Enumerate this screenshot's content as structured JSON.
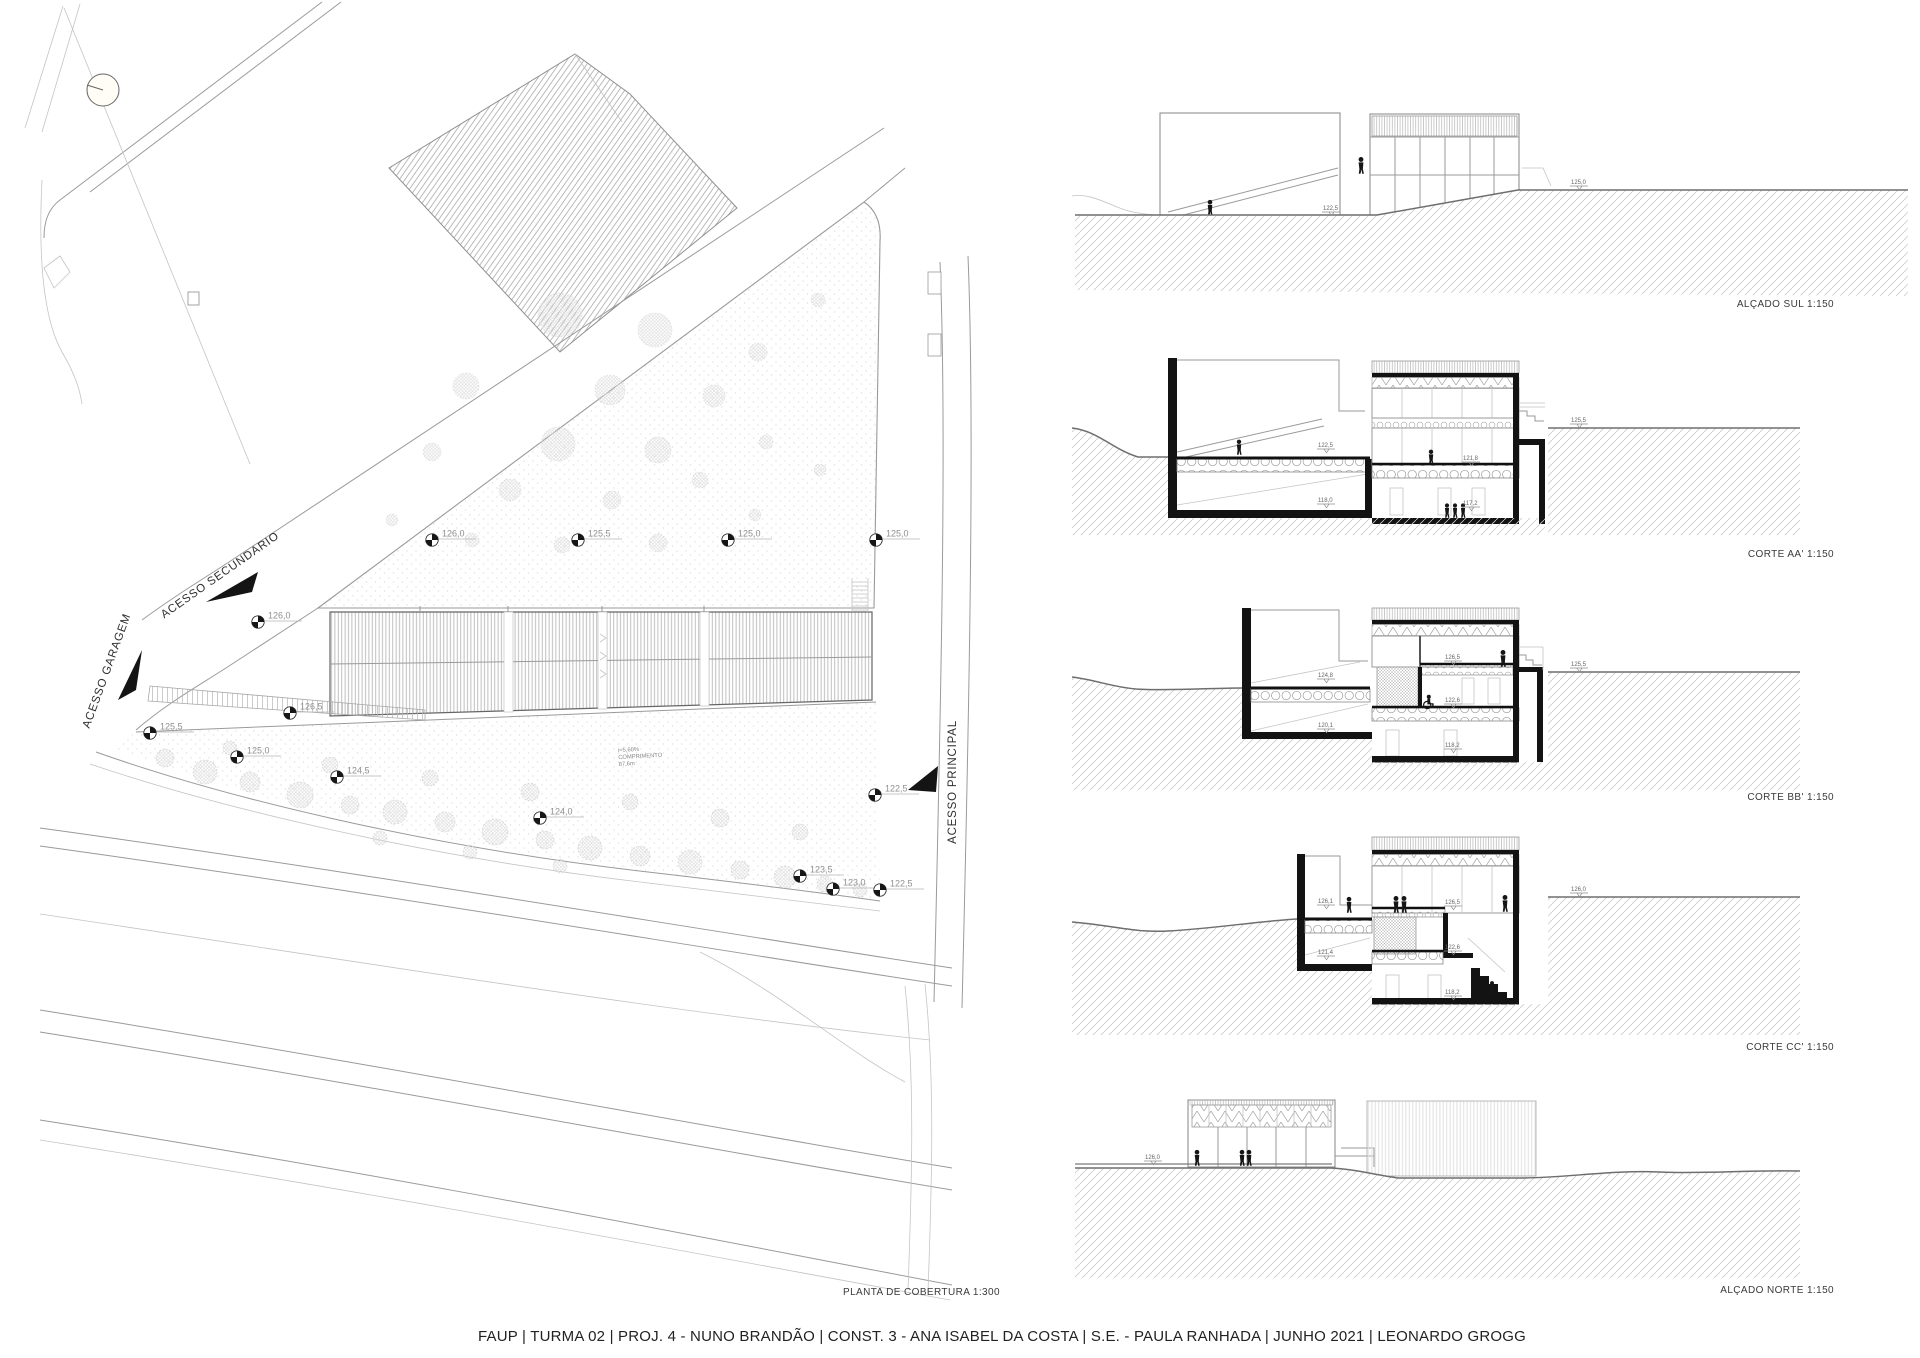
{
  "page": {
    "title": "FAUP | TURMA 02 | PROJ. 4 - NUNO BRANDÃO | CONST. 3 - ANA ISABEL DA COSTA | S.E. - PAULA RANHADA | JUNHO 2021 | LEONARDO GROGG"
  },
  "colors": {
    "paper": "#ffffff",
    "linework": "#9a9a9a",
    "section_poche": "#131313",
    "ground_hatch": "#cccccc",
    "terrain_line": "#6e6e6e"
  },
  "symbols": {
    "north": "north-indicator-circle",
    "benchmark": "survey-benchmark-quadrant-circle",
    "person": "person-silhouette",
    "arrow": "access-direction-arrow"
  },
  "site_plan": {
    "label": "PLANTA  DE COBERTURA 1:300",
    "access_labels": {
      "secondary": "ACESSO SECUNDARIO",
      "garage": "ACESSO GARAGEM",
      "principal": "ACESSO PRINCIPAL"
    },
    "ramp_note": {
      "slope": "i=5,60%",
      "caption": "COMPRIMENTO",
      "length": "87,6m"
    },
    "spot_elevations": [
      "126,0",
      "125,5",
      "125,0",
      "125,0",
      "126,0",
      "126,5",
      "125,5",
      "125,0",
      "124,5",
      "124,0",
      "123,5",
      "123,0",
      "122,5",
      "122,5"
    ]
  },
  "drawings": [
    {
      "id": "alcado-sul",
      "label": "ALÇADO SUL 1:150",
      "levels": [
        "122,5",
        "125,0"
      ]
    },
    {
      "id": "corte-aa",
      "label": "CORTE AA' 1:150",
      "levels": [
        "122,5",
        "118,0",
        "121,8",
        "117,2",
        "125,5"
      ]
    },
    {
      "id": "corte-bb",
      "label": "CORTE BB' 1:150",
      "levels": [
        "124,8",
        "120,1",
        "126,5",
        "122,6",
        "118,2",
        "125,5"
      ]
    },
    {
      "id": "corte-cc",
      "label": "CORTE CC' 1:150",
      "levels": [
        "126,1",
        "121,4",
        "126,5",
        "122,6",
        "118,2",
        "126,0"
      ]
    },
    {
      "id": "alcado-norte",
      "label": "ALÇADO NORTE 1:150",
      "levels": [
        "126,0"
      ]
    }
  ]
}
